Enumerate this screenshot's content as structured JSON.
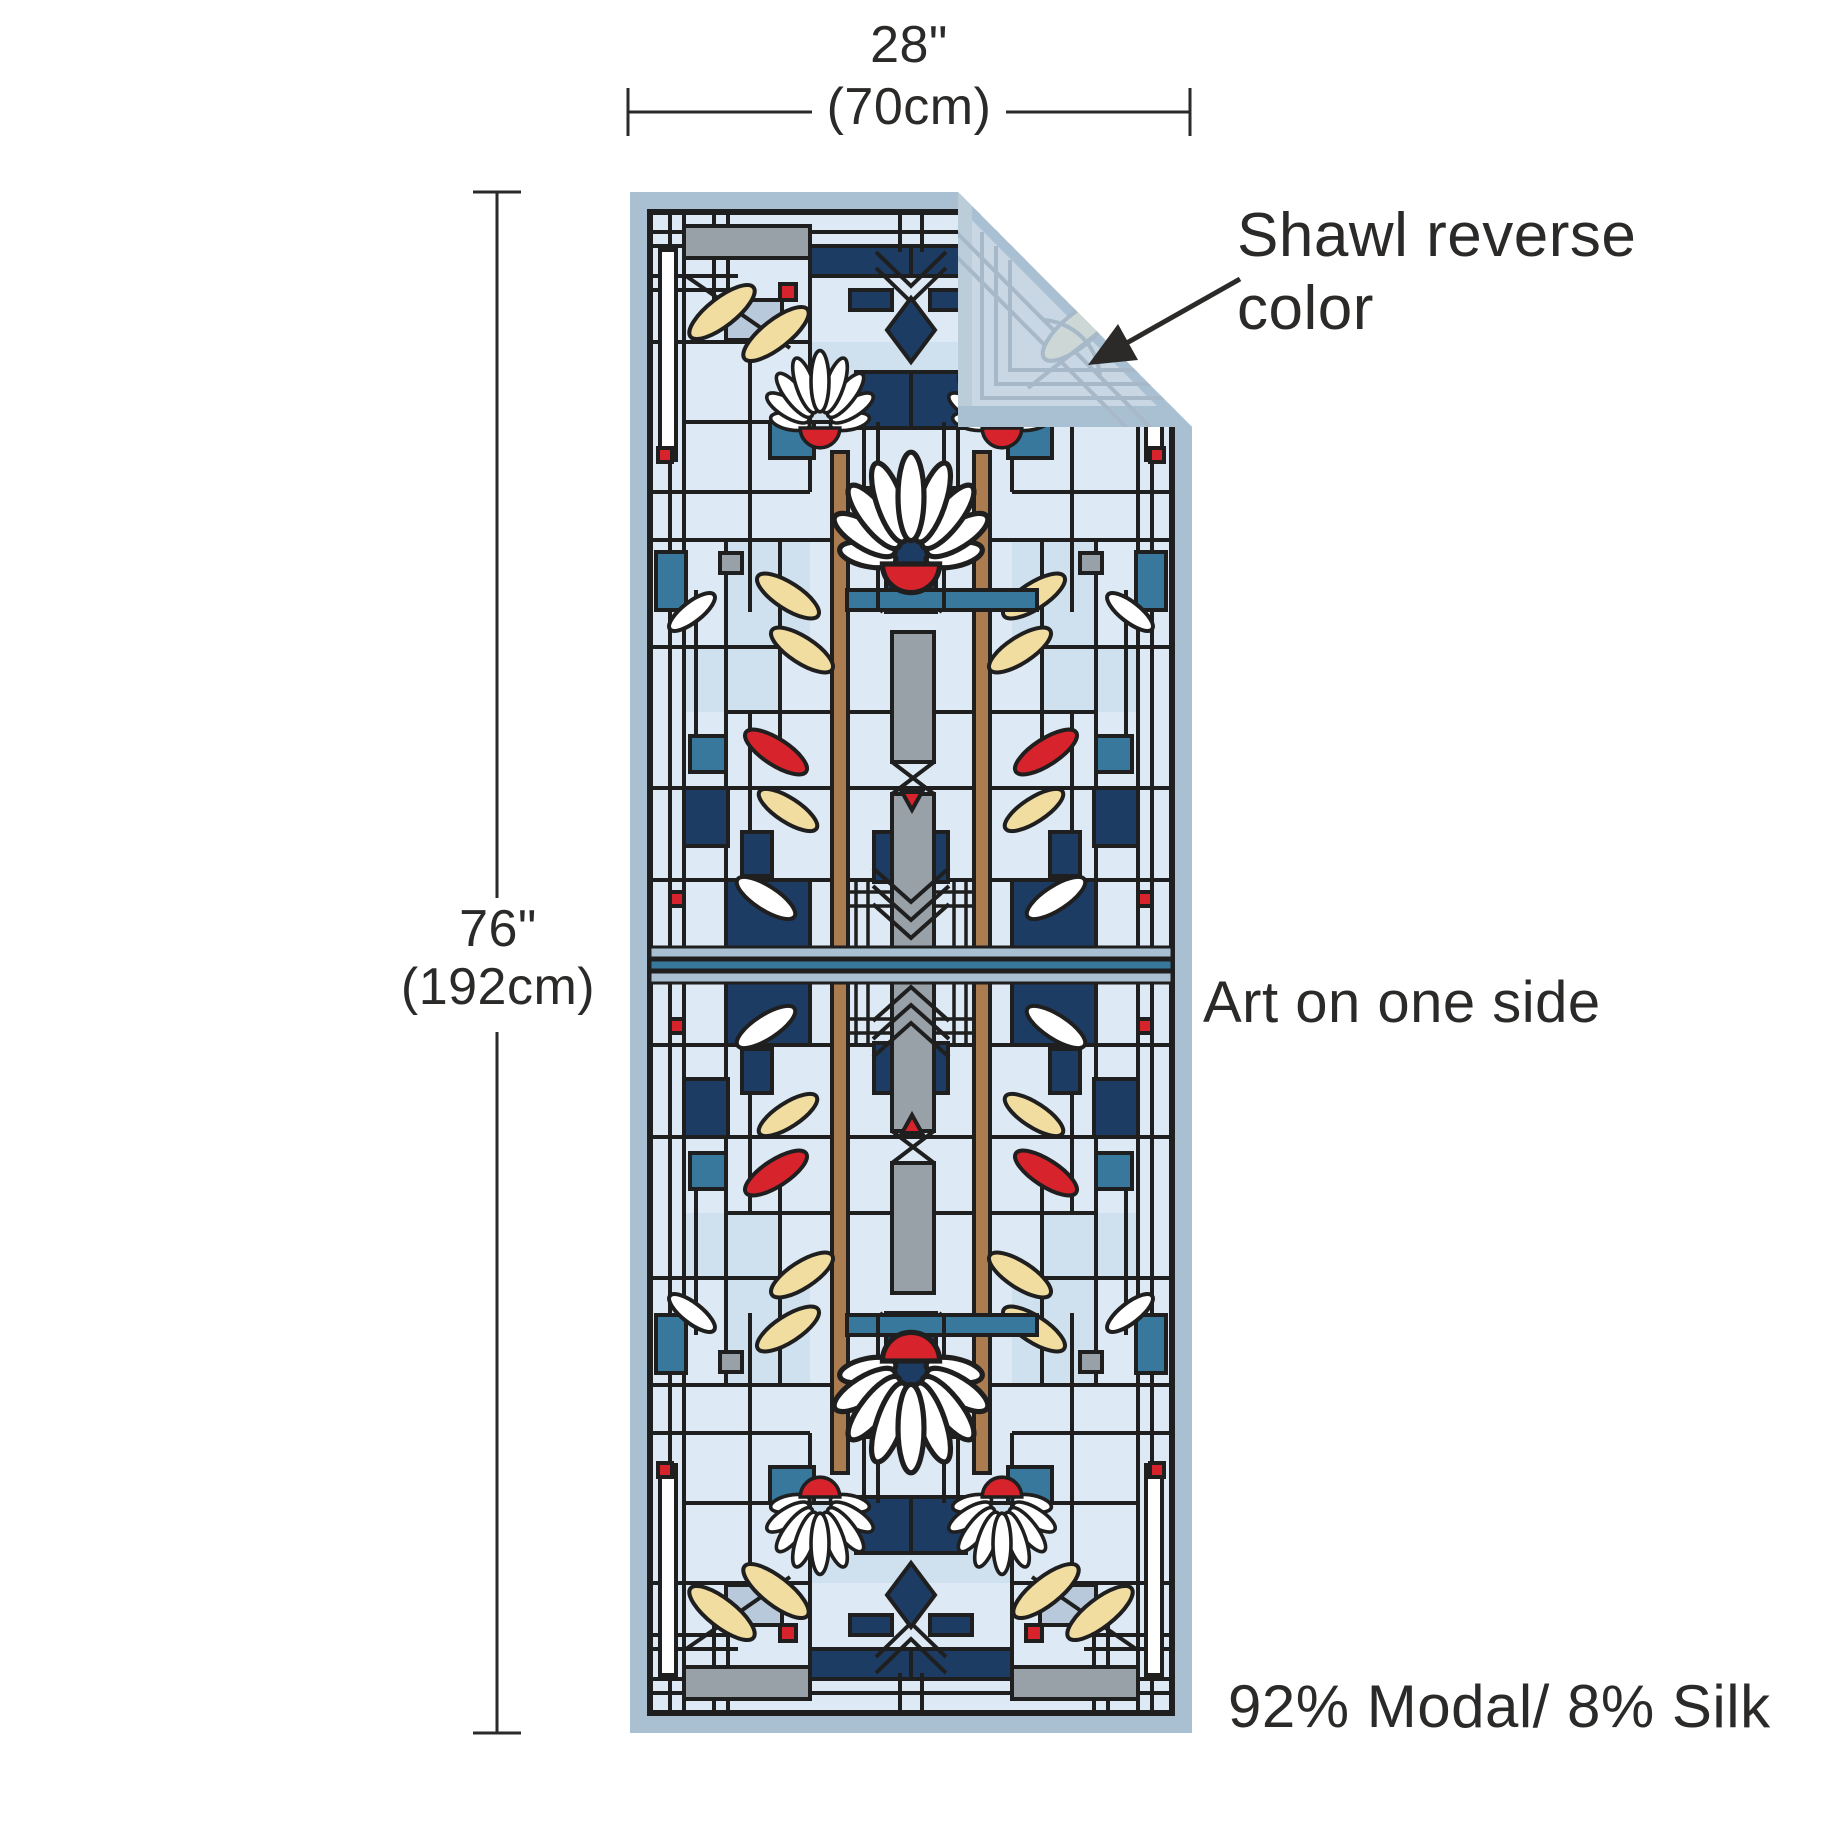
{
  "figure": {
    "type": "product-dimension-diagram",
    "product": "shawl with stained-glass waterlily artwork"
  },
  "dimensions": {
    "width_in": "28\"",
    "width_cm": "(70cm)",
    "height_in": "76\"",
    "height_cm": "(192cm)"
  },
  "annotations": {
    "reverse_line1": "Shawl reverse",
    "reverse_line2": "color",
    "art_side": "Art on one side",
    "material": "92% Modal/ 8% Silk"
  },
  "palette": {
    "line": "#1f1f1f",
    "text": "#2b2a29",
    "pale": "#dde9f4",
    "pale2": "#cfe0ee",
    "steel": "#a9c0d2",
    "navy": "#1c3c64",
    "teal": "#37789c",
    "slate": "#b7c9da",
    "gray": "#99a1a8",
    "brown": "#ab7c50",
    "red": "#d7232b",
    "cream": "#f2dda0",
    "white": "#ffffff",
    "reverse": "#c9d6e3",
    "ghost": "#a7b9c9",
    "ghostleaf": "#cdd7d5"
  }
}
